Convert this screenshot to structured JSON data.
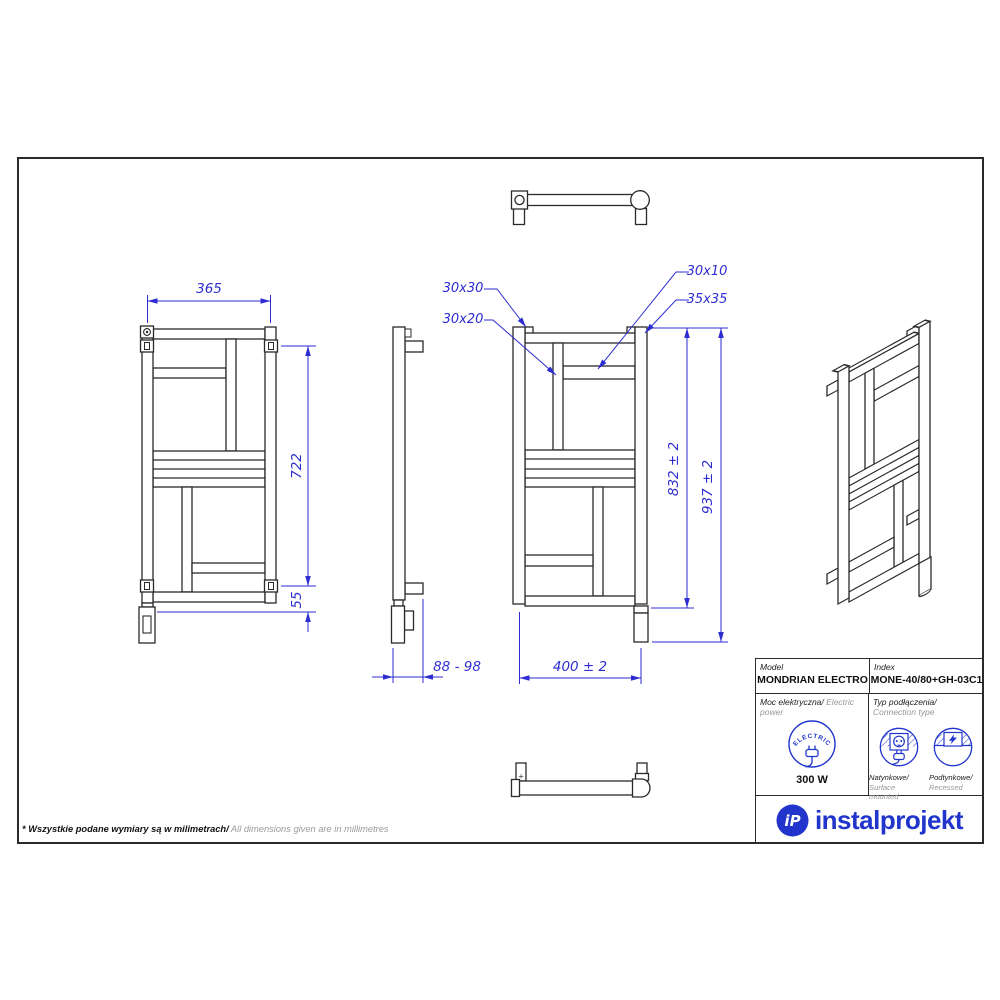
{
  "drawing": {
    "dimensions": {
      "front_left_width": "365",
      "front_left_height": "722",
      "front_left_bottom": "55",
      "side_depth": "88 - 98",
      "front_center_width": "400 ± 2",
      "front_center_height_inner": "832 ± 2",
      "front_center_height_total": "937 ± 2"
    },
    "callouts": {
      "top_tube": "30x30",
      "vertical_tube": "30x20",
      "cross_tube": "30x10",
      "side_tube": "35x35"
    },
    "marks": {
      "screw_plus": "+"
    }
  },
  "table": {
    "model_label": "Model",
    "model_value": "MONDRIAN ELECTRO",
    "index_label": "Index",
    "index_value": "MONE-40/80+GH-03C1",
    "power_label_pl": "Moc elektryczna/",
    "power_label_en": " Electric power",
    "power_icon_text": "ELECTRIC",
    "power_value": "300 W",
    "connection_label_pl": "Typ podłączenia/",
    "connection_label_en": "Connection type",
    "surface_label_pl": "Natynkowe/",
    "surface_label_en": "Surface mounted",
    "recessed_label_pl": "Podtynkowe/",
    "recessed_label_en": "Recessed"
  },
  "logo": {
    "mark": "iP",
    "name": "instalprojekt"
  },
  "footer": {
    "note_pl": "* Wszystkie podane wymiary są w milimetrach/",
    "note_en": " All dimensions given are in millimetres"
  },
  "colors": {
    "dimension_blue": "#2d2dd2",
    "brand_blue": "#2135cc",
    "line_dark": "#2a2a2a",
    "muted_gray": "#999999"
  }
}
